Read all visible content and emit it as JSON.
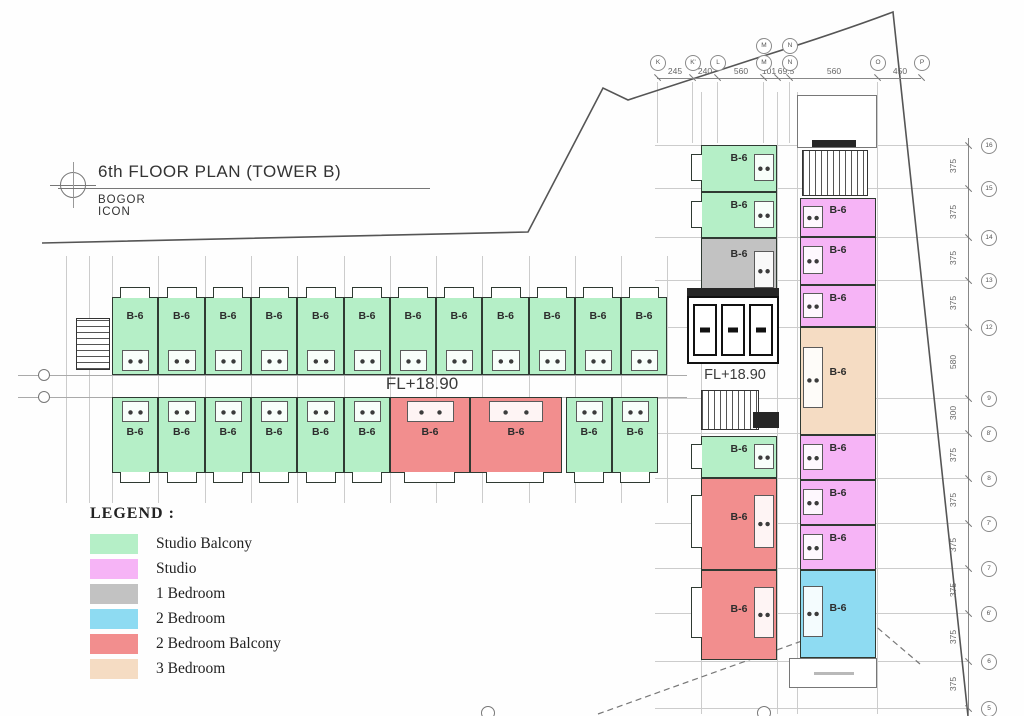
{
  "title": {
    "main": "6th FLOOR PLAN (TOWER B)",
    "sub": "BOGOR ICON"
  },
  "unit_code": "B-6",
  "floor_level_label": "FL+18.90",
  "legend": {
    "heading": "LEGEND :",
    "items": [
      {
        "label": "Studio Balcony",
        "type": "studio_balcony",
        "color": "#b5efc7"
      },
      {
        "label": "Studio",
        "type": "studio",
        "color": "#f6b4f6"
      },
      {
        "label": "1 Bedroom",
        "type": "one_bedroom",
        "color": "#c2c2c2"
      },
      {
        "label": "2 Bedroom",
        "type": "two_bedroom",
        "color": "#8edbf2"
      },
      {
        "label": "2 Bedroom Balcony",
        "type": "two_bedroom_balcony",
        "color": "#f28e8e"
      },
      {
        "label": "3 Bedroom",
        "type": "three_bedroom",
        "color": "#f5dcc3"
      }
    ]
  },
  "units": [
    {
      "no": "41",
      "type": "studio_balcony",
      "row": "top",
      "x": 112,
      "y": 297,
      "w": 46,
      "h": 78
    },
    {
      "no": "39",
      "type": "studio_balcony",
      "row": "top",
      "x": 158,
      "y": 297,
      "w": 47,
      "h": 78
    },
    {
      "no": "37",
      "type": "studio_balcony",
      "row": "top",
      "x": 205,
      "y": 297,
      "w": 46,
      "h": 78
    },
    {
      "no": "35",
      "type": "studio_balcony",
      "row": "top",
      "x": 251,
      "y": 297,
      "w": 46,
      "h": 78
    },
    {
      "no": "33",
      "type": "studio_balcony",
      "row": "top",
      "x": 297,
      "y": 297,
      "w": 47,
      "h": 78
    },
    {
      "no": "31",
      "type": "studio_balcony",
      "row": "top",
      "x": 344,
      "y": 297,
      "w": 46,
      "h": 78
    },
    {
      "no": "29",
      "type": "studio_balcony",
      "row": "top",
      "x": 390,
      "y": 297,
      "w": 46,
      "h": 78
    },
    {
      "no": "27",
      "type": "studio_balcony",
      "row": "top",
      "x": 436,
      "y": 297,
      "w": 46,
      "h": 78
    },
    {
      "no": "25",
      "type": "studio_balcony",
      "row": "top",
      "x": 482,
      "y": 297,
      "w": 47,
      "h": 78
    },
    {
      "no": "23",
      "type": "studio_balcony",
      "row": "top",
      "x": 529,
      "y": 297,
      "w": 46,
      "h": 78
    },
    {
      "no": "21",
      "type": "studio_balcony",
      "row": "top",
      "x": 575,
      "y": 297,
      "w": 46,
      "h": 78
    },
    {
      "no": "19",
      "type": "studio_balcony",
      "row": "top",
      "x": 621,
      "y": 297,
      "w": 46,
      "h": 78
    },
    {
      "no": "38",
      "type": "studio_balcony",
      "row": "bottom",
      "x": 112,
      "y": 397,
      "w": 46,
      "h": 76
    },
    {
      "no": "36",
      "type": "studio_balcony",
      "row": "bottom",
      "x": 158,
      "y": 397,
      "w": 47,
      "h": 76
    },
    {
      "no": "32",
      "type": "studio_balcony",
      "row": "bottom",
      "x": 205,
      "y": 397,
      "w": 46,
      "h": 76
    },
    {
      "no": "30",
      "type": "studio_balcony",
      "row": "bottom",
      "x": 251,
      "y": 397,
      "w": 46,
      "h": 76
    },
    {
      "no": "28",
      "type": "studio_balcony",
      "row": "bottom",
      "x": 297,
      "y": 397,
      "w": 47,
      "h": 76
    },
    {
      "no": "26",
      "type": "studio_balcony",
      "row": "bottom",
      "x": 344,
      "y": 397,
      "w": 46,
      "h": 76
    },
    {
      "no": "22",
      "type": "two_bedroom_balcony",
      "row": "bottom",
      "x": 390,
      "y": 397,
      "w": 80,
      "h": 76
    },
    {
      "no": "20",
      "type": "two_bedroom_balcony",
      "row": "bottom",
      "x": 470,
      "y": 397,
      "w": 92,
      "h": 76
    },
    {
      "no": "18B",
      "type": "studio_balcony",
      "row": "bottom",
      "x": 566,
      "y": 397,
      "w": 46,
      "h": 76
    },
    {
      "no": "18A",
      "type": "studio_balcony",
      "row": "bottom",
      "x": 612,
      "y": 397,
      "w": 46,
      "h": 76
    },
    {
      "no": "16",
      "type": "studio_balcony",
      "row": "rwl",
      "x": 701,
      "y": 145,
      "w": 76,
      "h": 47
    },
    {
      "no": "12",
      "type": "studio_balcony",
      "row": "rwl",
      "x": 701,
      "y": 192,
      "w": 76,
      "h": 46
    },
    {
      "no": "10",
      "type": "one_bedroom",
      "row": "rwl",
      "x": 701,
      "y": 238,
      "w": 76,
      "h": 66
    },
    {
      "no": "08",
      "type": "studio_balcony",
      "row": "rwl",
      "x": 701,
      "y": 436,
      "w": 76,
      "h": 42
    },
    {
      "no": "06",
      "type": "two_bedroom_balcony",
      "row": "rwl",
      "x": 701,
      "y": 478,
      "w": 76,
      "h": 92
    },
    {
      "no": "02",
      "type": "two_bedroom_balcony",
      "row": "rwl",
      "x": 701,
      "y": 570,
      "w": 76,
      "h": 90
    },
    {
      "no": "17",
      "type": "studio",
      "row": "rwr",
      "x": 800,
      "y": 198,
      "w": 76,
      "h": 39
    },
    {
      "no": "15",
      "type": "studio",
      "row": "rwr",
      "x": 800,
      "y": 237,
      "w": 76,
      "h": 48
    },
    {
      "no": "11",
      "type": "studio",
      "row": "rwr",
      "x": 800,
      "y": 285,
      "w": 76,
      "h": 42
    },
    {
      "no": "09",
      "type": "three_bedroom",
      "row": "rwr",
      "x": 800,
      "y": 327,
      "w": 76,
      "h": 108
    },
    {
      "no": "07",
      "type": "studio",
      "row": "rwr",
      "x": 800,
      "y": 435,
      "w": 76,
      "h": 45
    },
    {
      "no": "05",
      "type": "studio",
      "row": "rwr",
      "x": 800,
      "y": 480,
      "w": 76,
      "h": 45
    },
    {
      "no": "03",
      "type": "studio",
      "row": "rwr",
      "x": 800,
      "y": 525,
      "w": 76,
      "h": 45
    },
    {
      "no": "01",
      "type": "two_bedroom",
      "row": "rwr",
      "x": 800,
      "y": 570,
      "w": 76,
      "h": 88
    }
  ],
  "dimensions": {
    "top": {
      "ticks": [
        657,
        692,
        717,
        763,
        777,
        789,
        877,
        921
      ],
      "bubbles": [
        {
          "label": "K",
          "x": 657
        },
        {
          "label": "K'",
          "x": 692
        },
        {
          "label": "L",
          "x": 717
        },
        {
          "label": "M",
          "x": 763,
          "stacked": true
        },
        {
          "label": "N",
          "x": 789,
          "stacked": true
        },
        {
          "label": "O",
          "x": 877
        },
        {
          "label": "P",
          "x": 921
        }
      ],
      "values": [
        {
          "text": "245",
          "x": 674
        },
        {
          "text": "240",
          "x": 704
        },
        {
          "text": "560",
          "x": 740
        },
        {
          "text": "101",
          "x": 768
        },
        {
          "text": "69.5",
          "x": 785
        },
        {
          "text": "560",
          "x": 833
        },
        {
          "text": "450",
          "x": 899
        }
      ]
    },
    "right": {
      "bubbles": [
        {
          "label": "16",
          "y": 145
        },
        {
          "label": "15",
          "y": 188
        },
        {
          "label": "14",
          "y": 237
        },
        {
          "label": "13",
          "y": 280
        },
        {
          "label": "12",
          "y": 327
        },
        {
          "label": "9",
          "y": 398
        },
        {
          "label": "8'",
          "y": 433
        },
        {
          "label": "8",
          "y": 478
        },
        {
          "label": "7'",
          "y": 523
        },
        {
          "label": "7",
          "y": 568
        },
        {
          "label": "6'",
          "y": 613
        },
        {
          "label": "6",
          "y": 661
        },
        {
          "label": "5",
          "y": 708
        }
      ],
      "values": [
        {
          "text": "375",
          "y": 166
        },
        {
          "text": "375",
          "y": 212
        },
        {
          "text": "375",
          "y": 258
        },
        {
          "text": "375",
          "y": 303
        },
        {
          "text": "580",
          "y": 362
        },
        {
          "text": "300",
          "y": 413
        },
        {
          "text": "375",
          "y": 455
        },
        {
          "text": "375",
          "y": 500
        },
        {
          "text": "375",
          "y": 545
        },
        {
          "text": "375",
          "y": 590
        },
        {
          "text": "375",
          "y": 637
        },
        {
          "text": "375",
          "y": 684
        }
      ]
    }
  }
}
